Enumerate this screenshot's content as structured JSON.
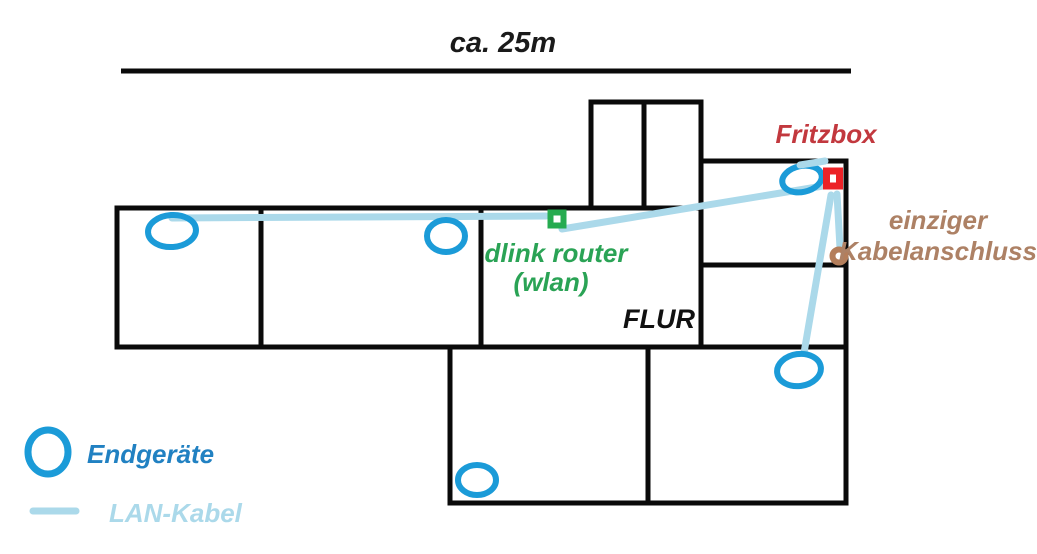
{
  "scale": {
    "label": "ca. 25m"
  },
  "rooms": {
    "flur_label": "FLUR"
  },
  "network": {
    "fritzbox_label": "Fritzbox",
    "kabelanschluss_label_line1": "einziger",
    "kabelanschluss_label_line2": "Kabelanschluss",
    "dlink_label_line1": "dlink router",
    "dlink_label_line2": "(wlan)"
  },
  "legend": {
    "endgeraete_label": "Endgeräte",
    "lan_kabel_label": "LAN-Kabel"
  },
  "colors": {
    "wall_black": "#0a0a0a",
    "scale_text_black": "#1a1a1a",
    "flur_text_black": "#111111",
    "device_blue": "#1b9bd8",
    "cable_light_blue": "#abd9ea",
    "fritzbox_marker_red": "#ec2227",
    "fritzbox_text_red": "#c2383e",
    "dlink_marker_green": "#26ab50",
    "dlink_text_green": "#2aa355",
    "kabelanschluss_marker_brown": "#b47e5b",
    "kabelanschluss_text_brown": "#ad8165",
    "endgeraete_text_blue": "#2181c2"
  }
}
